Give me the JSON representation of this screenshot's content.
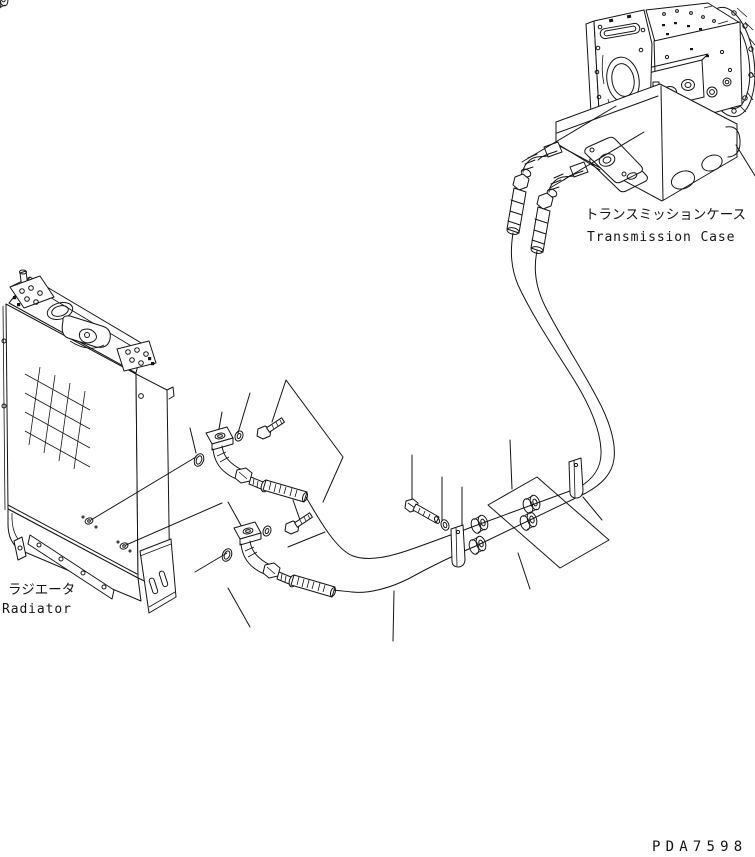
{
  "diagram": {
    "labels": {
      "transmission_case_jp": "トランスミッションケース",
      "transmission_case_en": "Transmission Case",
      "radiator_jp": "ラジエータ",
      "radiator_en": "Radiator"
    },
    "drawing_number": "PDA7598",
    "colors": {
      "line_color": "#141414",
      "background": "#ffffff"
    }
  }
}
